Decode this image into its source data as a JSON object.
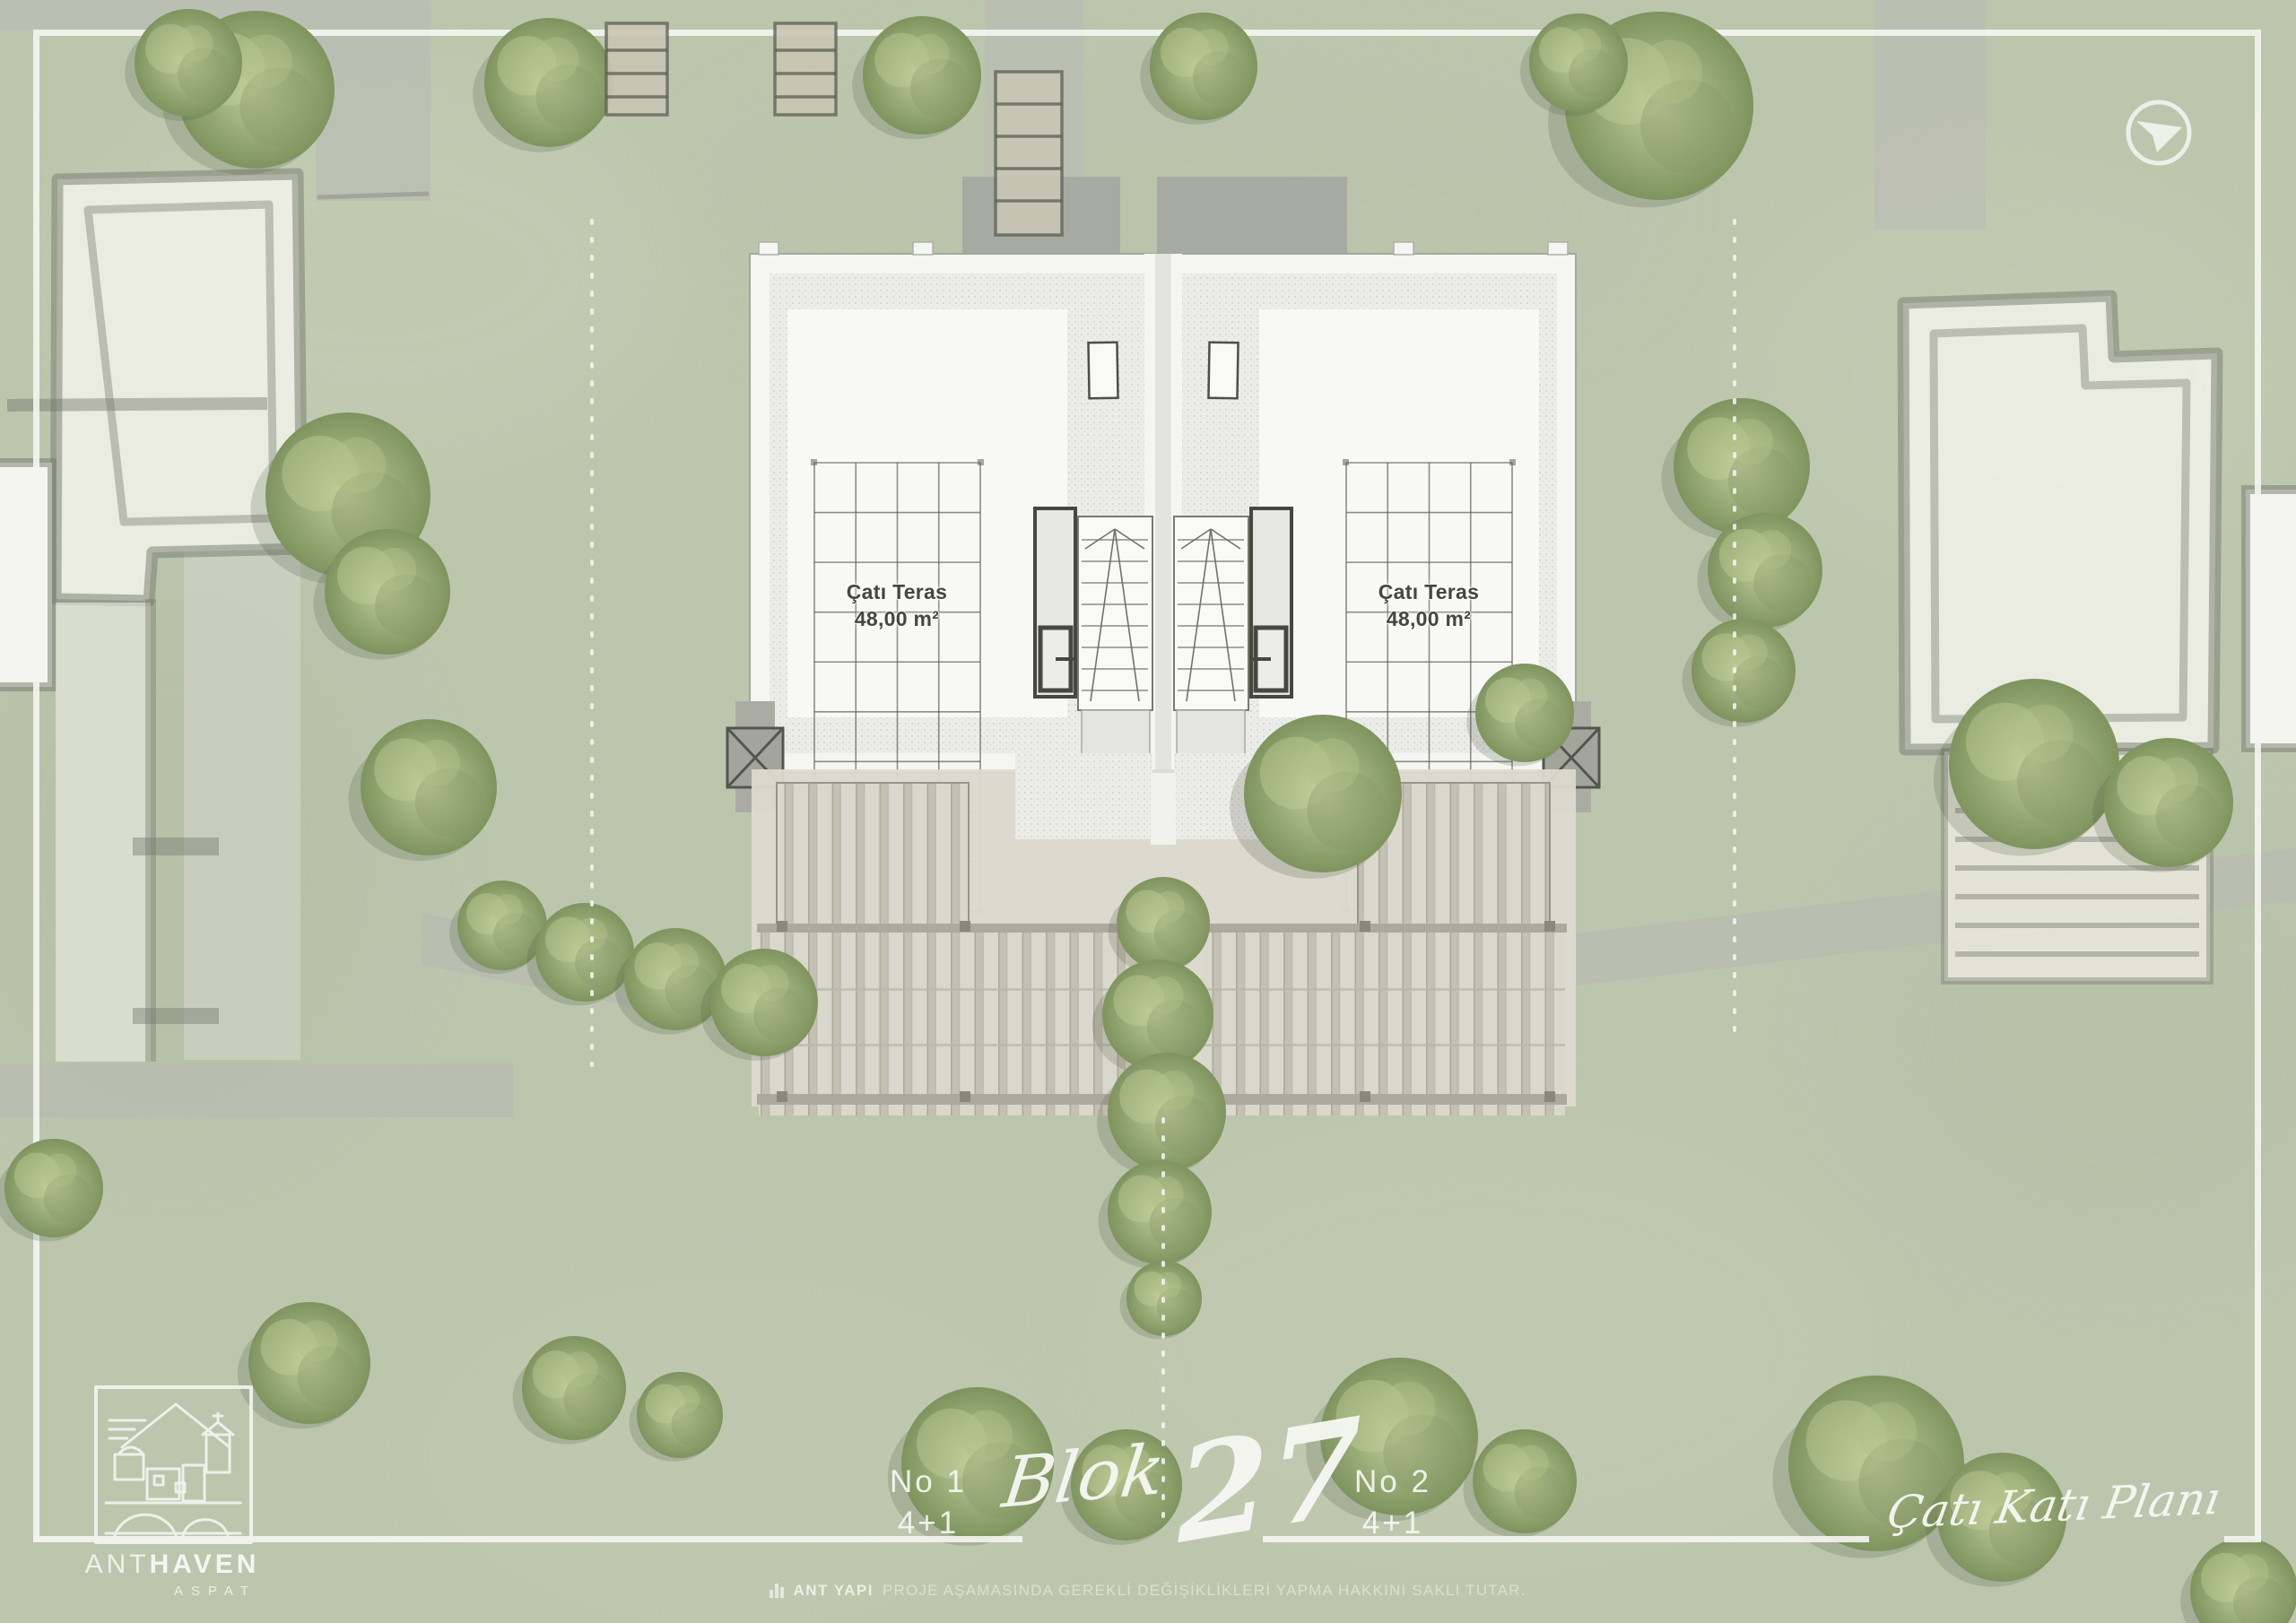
{
  "page": {
    "plan_title": "Çatı Katı Planı",
    "block_label": "Blok",
    "block_number": "27"
  },
  "units": [
    {
      "no": "No 1",
      "type": "4+1",
      "terrace_label": "Çatı Teras",
      "terrace_area": "48,00 m²"
    },
    {
      "no": "No 2",
      "type": "4+1",
      "terrace_label": "Çatı Teras",
      "terrace_area": "48,00 m²"
    }
  ],
  "brand": {
    "name_regular": "ANT",
    "name_bold": "HAVEN",
    "subtitle": "ASPAT"
  },
  "disclaimer": {
    "company": "ANT YAPI",
    "text": "PROJE AŞAMASINDA GEREKLİ DEĞİŞİKLİKLERİ YAPMA HAKKINI SAKLI TUTAR."
  },
  "icons": {
    "north_arrow": "north-arrow-icon",
    "brand_bars": "bar-chart-icon"
  },
  "colors": {
    "grass_green": "#b7c2a8",
    "frame_white": "#f4f5f1",
    "building_white": "#f7f8f5",
    "gravel_stipple": "#ececea",
    "road_gray": "#b6b9ae",
    "slab_gray": "#9fa19a",
    "deck_wood": "#d9d5ca",
    "sketch_ink": "#676b60",
    "tree_green": "#96a877",
    "label_ink": "#44463f",
    "text_white": "#f7f8f4"
  }
}
